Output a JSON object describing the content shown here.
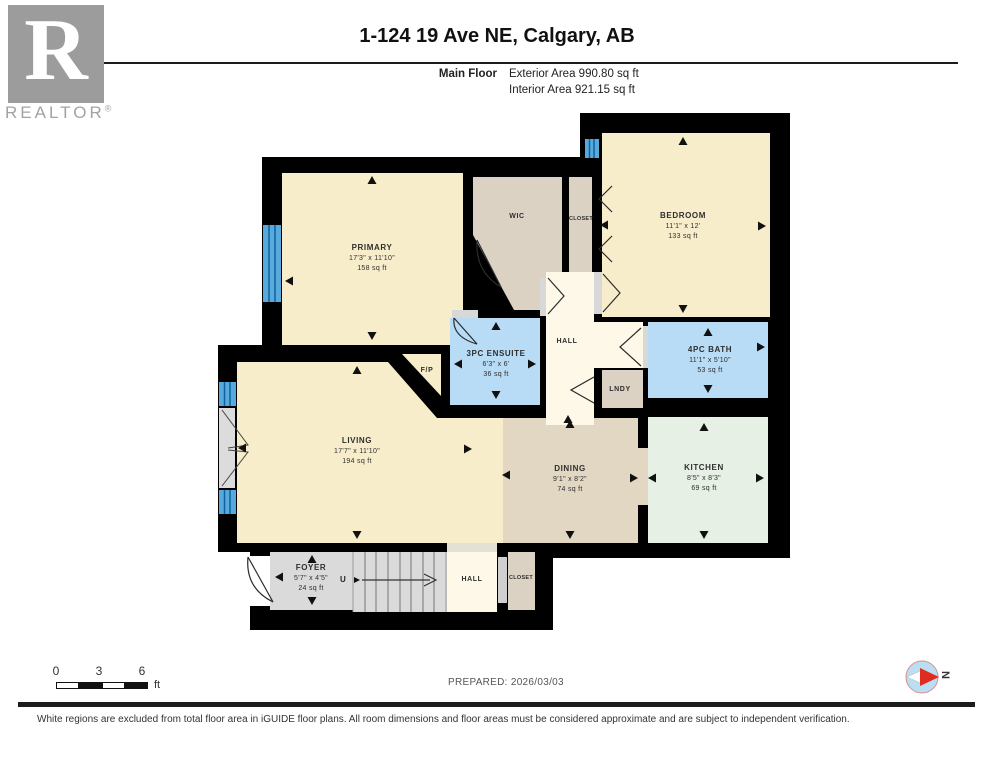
{
  "header": {
    "title": "1-124 19 Ave NE, Calgary, AB",
    "floor_label": "Main Floor",
    "exterior_area": "Exterior Area 990.80 sq ft",
    "interior_area": "Interior Area 921.15 sq ft"
  },
  "logo": {
    "letter": "R",
    "wordmark": "REALTOR",
    "registered": "®"
  },
  "rooms": [
    {
      "id": "primary",
      "name": "PRIMARY",
      "dims": "17'3\" x 11'10\"",
      "area": "158 sq ft"
    },
    {
      "id": "wic",
      "name": "WIC"
    },
    {
      "id": "closet-upper",
      "name": "CLOSET"
    },
    {
      "id": "bedroom",
      "name": "BEDROOM",
      "dims": "11'1\" x 12'",
      "area": "133 sq ft"
    },
    {
      "id": "hall-upper",
      "name": "HALL"
    },
    {
      "id": "ensuite",
      "name": "3PC ENSUITE",
      "dims": "6'3\" x 6'",
      "area": "36 sq ft"
    },
    {
      "id": "bath",
      "name": "4PC BATH",
      "dims": "11'1\" x 5'10\"",
      "area": "53 sq ft"
    },
    {
      "id": "lndy",
      "name": "LNDY"
    },
    {
      "id": "living",
      "name": "LIVING",
      "dims": "17'7\" x 11'10\"",
      "area": "194 sq ft"
    },
    {
      "id": "dining",
      "name": "DINING",
      "dims": "9'1\" x 8'2\"",
      "area": "74 sq ft"
    },
    {
      "id": "kitchen",
      "name": "KITCHEN",
      "dims": "8'5\" x 8'3\"",
      "area": "69 sq ft"
    },
    {
      "id": "foyer",
      "name": "FOYER",
      "dims": "5'7\" x 4'5\"",
      "area": "24 sq ft"
    },
    {
      "id": "hall-lower",
      "name": "HALL"
    },
    {
      "id": "closet-lower",
      "name": "CLOSET"
    },
    {
      "id": "fireplace",
      "name": "F/P"
    }
  ],
  "labels": {
    "up": "U"
  },
  "scale_bar": {
    "ticks": [
      "0",
      "3",
      "6"
    ],
    "unit": "ft"
  },
  "compass": {
    "north_label": "N"
  },
  "footer": {
    "prepared": "PREPARED: 2026/03/03",
    "disclaimer": "White regions are excluded from total floor area in iGUIDE floor plans. All room dimensions and floor areas must be considered approximate and are subject to independent verification."
  },
  "colors": {
    "wall": "#000000",
    "room_cream": "#f7edca",
    "hall_cream": "#fdf8e7",
    "bath_blue": "#b8dcf5",
    "window_blue": "#58aadc",
    "closet_beige": "#dbd2c4",
    "dining_tan": "#e2d7c3",
    "kitchen_mint": "#e6f0e5",
    "foyer_gray": "#dadada",
    "compass_red": "#e02b20"
  }
}
